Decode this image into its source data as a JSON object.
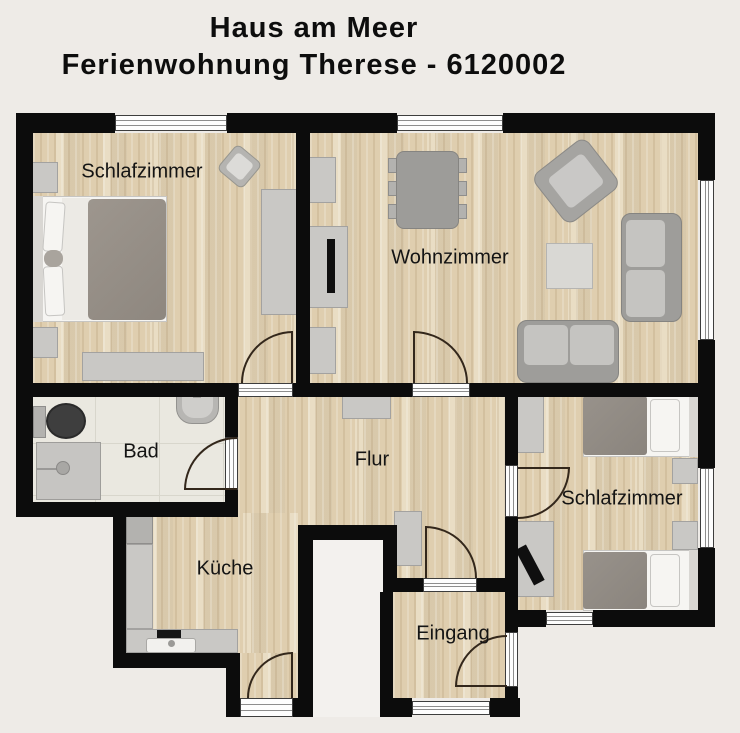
{
  "title": {
    "line1": "Haus am Meer",
    "line2": "Ferienwohnung Therese - 6120002"
  },
  "rooms": {
    "bedroom_left": {
      "label": "Schlafzimmer"
    },
    "living_room": {
      "label": "Wohnzimmer"
    },
    "bathroom": {
      "label": "Bad"
    },
    "hallway": {
      "label": "Flur"
    },
    "bedroom_right": {
      "label": "Schlafzimmer"
    },
    "kitchen": {
      "label": "Küche"
    },
    "entrance": {
      "label": "Eingang"
    }
  },
  "palette": {
    "background": "#eeebe7",
    "wall": "#0c0c0c",
    "wood_floor": "#e6d8bc",
    "bath_tile": "#eae8e0",
    "furniture_light": "#c9c8c5",
    "furniture_mid": "#b3b2af",
    "bed_blanket": "#948d85",
    "window_white": "#fdfdfd"
  }
}
